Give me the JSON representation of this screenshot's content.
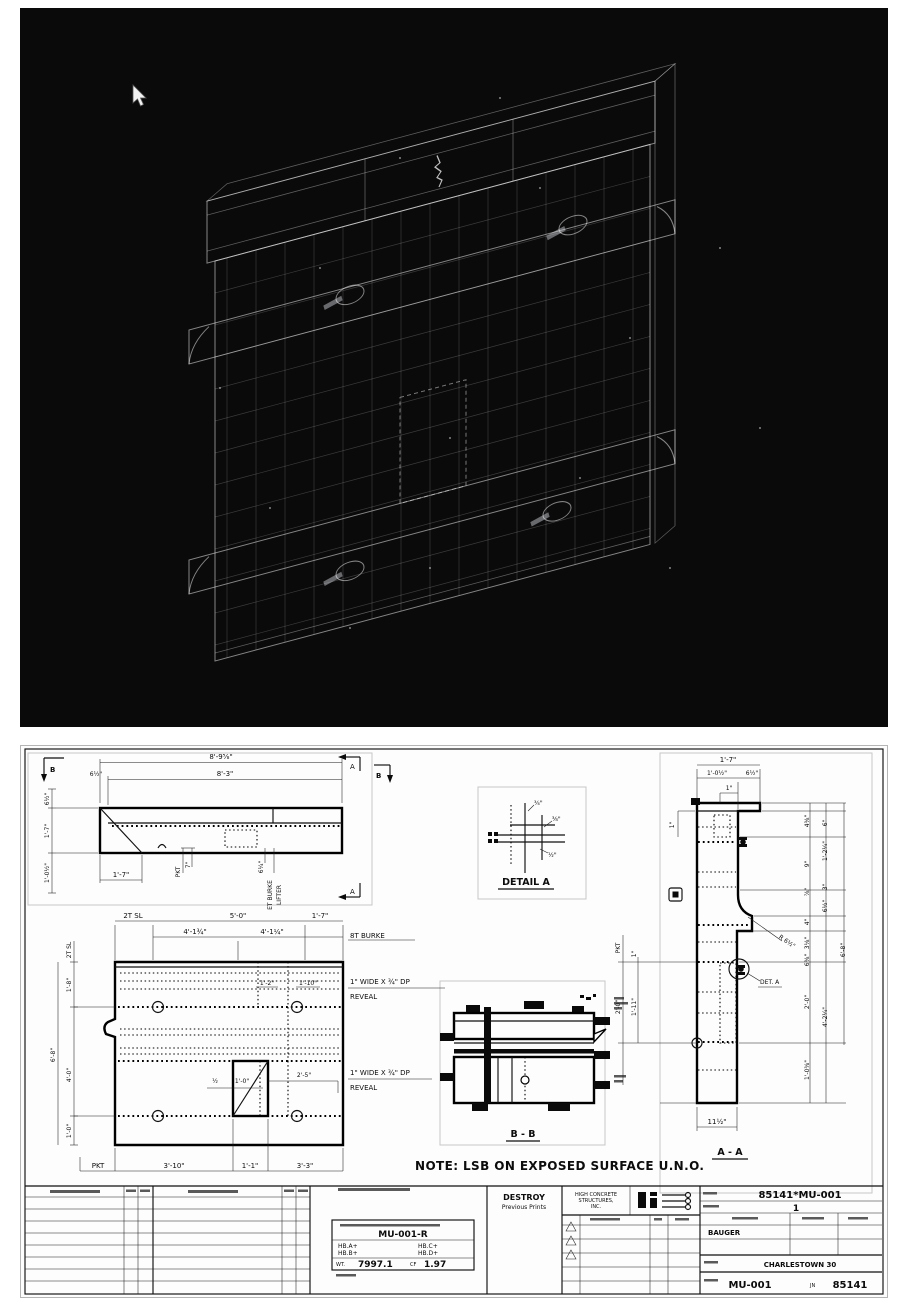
{
  "viewer": {
    "hint": "3d-wireframe-panel"
  },
  "plan": {
    "dim_overall": "8'-9⅝\"",
    "dim_body": "8'-3\"",
    "dim_offset": "6½\"",
    "left_top": "6½\"",
    "left_mid": "1'-7\"",
    "left_bot": "1'-0½\"",
    "dim_end": "1'-7\"",
    "pkt": "PKT",
    "pkt_dim": "7\"",
    "lift_dim": "6¼\"",
    "burke1": "ET BURKE",
    "burke2": "LIFTER",
    "marker_a": "A",
    "marker_b": "B"
  },
  "elev": {
    "top1": "2T SL",
    "top2": "5'-0\"",
    "top3": "1'-7\"",
    "top4": "4'-1¾\"",
    "top5": "4'-1¼\"",
    "burke": "8T BURKE",
    "left1": "2T SL",
    "left2": "1'-8\"",
    "left3": "6'-8\"",
    "left4": "4'-0\"",
    "left5": "1'-0\"",
    "mid1": "1'-2\"",
    "mid2": "1'-10\"",
    "reveal1": "1\" WIDE X ¾\" DP",
    "reveal2": "REVEAL",
    "blk1": "½",
    "blk2": "1'-0\"",
    "blk3": "2'-5\"",
    "bot0": "PKT",
    "bot1": "3'-10\"",
    "bot2": "1'-1\"",
    "bot3": "3'-3\""
  },
  "detail": {
    "title": "DETAIL A",
    "d1": "¾\"",
    "d2": "⅜\"",
    "d3": "½\""
  },
  "bb": {
    "title": "B - B"
  },
  "aa": {
    "title": "A - A",
    "top1": "1'-7\"",
    "top2": "1'-0½\"",
    "top3": "6½\"",
    "top4": "1\"",
    "l0": "1\"",
    "l1": "PKT",
    "l2": "1\"",
    "l3": "2'-0\"",
    "l4": "1'-11\"",
    "r1": "4⅜\"",
    "r2": "6\"",
    "r3": "9\"",
    "r4": "1'-2¼\"",
    "r5": "⅞\"",
    "r6": "3\"",
    "r7": "6½\"",
    "r8": "4\"",
    "r9": "3⅛\"",
    "r10": "6⅜\"",
    "r11": "6'-8\"",
    "r12": "2'-0\"",
    "r13": "4'-2¼\"",
    "r14": "1'-0⅜\"",
    "bot": "11½\"",
    "radius": "R 6½\"",
    "det": "DET. A"
  },
  "note": "NOTE:  LSB ON EXPOSED SURFACE U.N.O.",
  "tb": {
    "mark_full": "85141*MU-001",
    "laterals": "1",
    "drawn": "BAUGER",
    "project": "CHARLESTOWN 30",
    "mark": "MU-001",
    "jn": "JN",
    "job": "85141",
    "piece": "MU-001-R",
    "hba": "HB.A+",
    "hbb": "HB.B+",
    "hbc": "HB.C+",
    "hbd": "HB.D+",
    "wt_l": "WT.",
    "wt": "7997.1",
    "cf_l": "CF",
    "cf": "1.97",
    "destroy1": "DESTROY",
    "destroy2": "Previous Prints",
    "co1": "HIGH CONCRETE",
    "co2": "STRUCTURES,",
    "co3": "INC."
  }
}
